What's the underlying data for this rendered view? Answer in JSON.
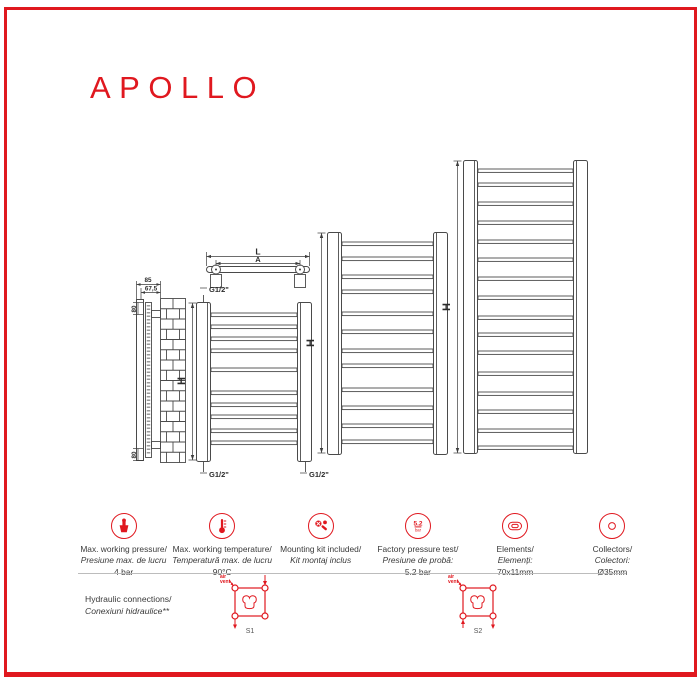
{
  "accent": "#e0181f",
  "title": "APOLLO",
  "drawing": {
    "height_label": "H",
    "length_label": "L",
    "axis_label": "A",
    "thread_label": "G1/2\"",
    "depth_dim": "85",
    "axis_depth_dim": "67,5",
    "top_offset_dim": "80",
    "bottom_offset_dim": "80"
  },
  "specs": [
    {
      "icon": "pressure-gauge-icon",
      "line1": "Max. working pressure/",
      "line2": "Presiune max. de lucru",
      "line3": "4 bar"
    },
    {
      "icon": "thermometer-icon",
      "line1": "Max. working temperature/",
      "line2": "Temperatură max. de lucru",
      "line3": "90°C"
    },
    {
      "icon": "mounting-kit-icon",
      "line1": "Mounting kit included/",
      "line2": "Kit montaj inclus",
      "line3": ""
    },
    {
      "icon": "pressure-test-icon",
      "icon_value": "5.2",
      "icon_unit": "bar",
      "line1": "Factory pressure test/",
      "line2": "Presiune de probă:",
      "line3": "5.2 bar"
    },
    {
      "icon": "element-profile-icon",
      "line1": "Elements/",
      "line2": "Elemenți:",
      "line3": "70x11mm"
    },
    {
      "icon": "collector-icon",
      "line1": "Collectors/",
      "line2": "Colectori:",
      "line3": "Ø35mm"
    }
  ],
  "hydraulic": {
    "title_en": "Hydraulic connections/",
    "title_ro": "Conexiuni hidraulice**",
    "air_vent_line1": "air",
    "air_vent_line2": "vent",
    "diagram1_label": "S1",
    "diagram2_label": "S2"
  }
}
